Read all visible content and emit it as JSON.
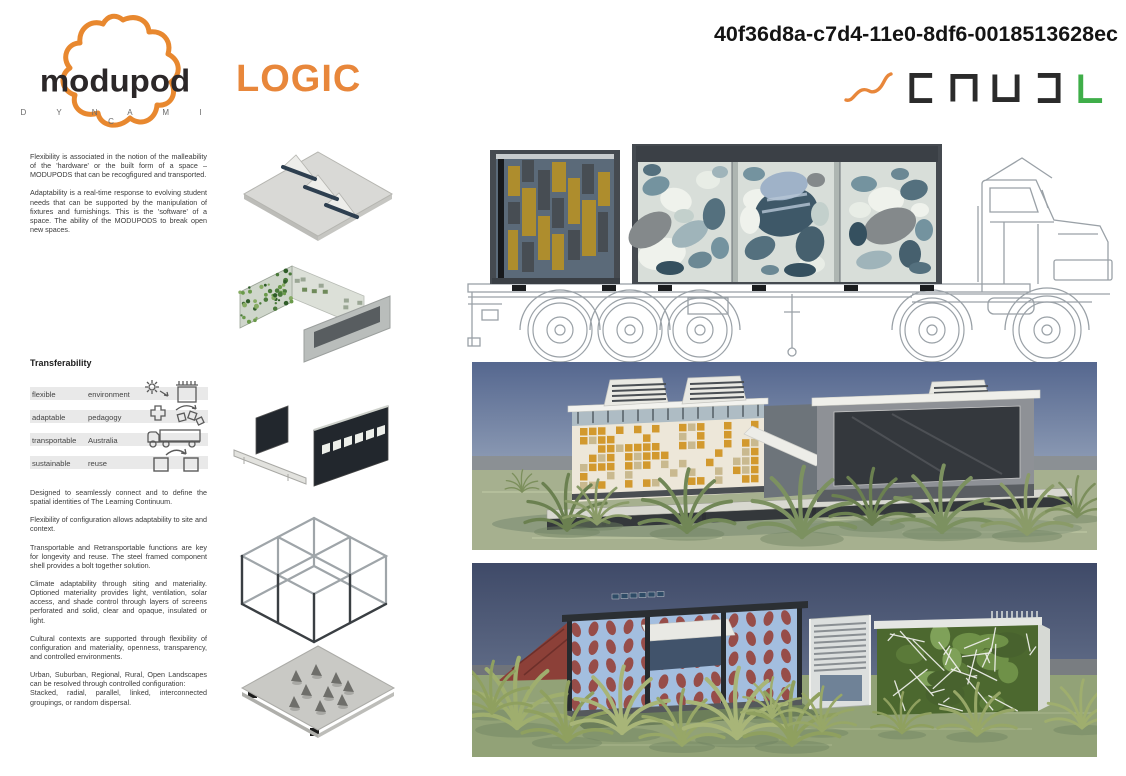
{
  "page": {
    "width": 1126,
    "height": 776,
    "background": "#ffffff"
  },
  "header": {
    "logo": {
      "wordmark": "MODUPOD",
      "sub_wordmark": "D Y N A M I C",
      "blob_color": "#E8882F",
      "wordmark_color": "#2B2728"
    },
    "series_title": "LOGIC",
    "series_title_color": "#E8873B",
    "document_id": "40f36d8a-c7d4-11e0-8df6-0018513628ec",
    "brand_marks": {
      "icons": [
        "squiggle-icon",
        "bracket-open-right-icon",
        "bracket-open-bottom-icon",
        "bracket-open-top-icon",
        "bracket-open-left-icon",
        "l-bracket-icon"
      ],
      "squiggle_color": "#E8873B",
      "bracket_color": "#2B2B2B",
      "l_color": "#3FAE49"
    }
  },
  "intro": {
    "paragraphs": [
      "Flexibility is associated in the notion of the malleability of the 'hardware' or the built form of a space – MODUPODS that can be recogfigured and transported.",
      "Adaptability is a real-time response to evolving student needs that can be supported by the manipulation of fixtures and furnishings.  This is the 'software' of a space.  The ability of the MODUPODS to break open new spaces."
    ]
  },
  "transferability": {
    "heading": "Transferability",
    "rows": [
      {
        "term": "flexible",
        "value": "environment",
        "icon": "sun-to-shade-box-icon"
      },
      {
        "term": "adaptable",
        "value": "pedagogy",
        "icon": "cross-plan-scatter-icon"
      },
      {
        "term": "transportable",
        "value": "Australia",
        "icon": "truck-icon"
      },
      {
        "term": "sustainable",
        "value": "reuse",
        "icon": "box-reuse-arrow-icon"
      }
    ]
  },
  "body": {
    "paragraphs": [
      "Designed to seamlessly connect and to define the spatial identities of The Learning Continuum.",
      "Flexibility of configuration allows adaptability to site and context.",
      "Transportable and Retransportable functions are key for longevity and reuse.  The steel framed component shell provides a bolt together solution.",
      "Climate adaptability through siting and materiality. Optioned materiality provides light, ventilation, solar access, and shade control through layers of screens perforated and solid, clear and opaque, insulated or light.",
      "Cultural contexts are supported through flexibility of configuration and materiality, openness, transparency, and controlled environments.",
      "Urban, Suburban, Regional, Rural, Open Landscapes can be resolved through controlled configuration:",
      "Stacked, radial, parallel, linked, interconnected groupings, or random dispersal."
    ]
  },
  "figures": {
    "exploded_diagrams": [
      {
        "name": "roof-plate-with-skylight-fins"
      },
      {
        "name": "wall-assembly-with-green-screen"
      },
      {
        "name": "screen-wall-panels"
      },
      {
        "name": "steel-frame-shell"
      },
      {
        "name": "floor-plate"
      }
    ],
    "truck_elevation": {
      "description": "two modupod modules on semi-trailer line drawing",
      "module_colors": {
        "mustard": "#AE8D2D",
        "slate": "#5B6A79",
        "teal": "#74939F",
        "frame": "#454A50"
      }
    },
    "render_day": {
      "description": "deployed modupod day render",
      "sky": "#55678F",
      "grass": "#A6B08F"
    },
    "render_dusk": {
      "description": "deployed modupod dusk render",
      "sky": "#3F4A68",
      "grass": "#92A277"
    }
  }
}
